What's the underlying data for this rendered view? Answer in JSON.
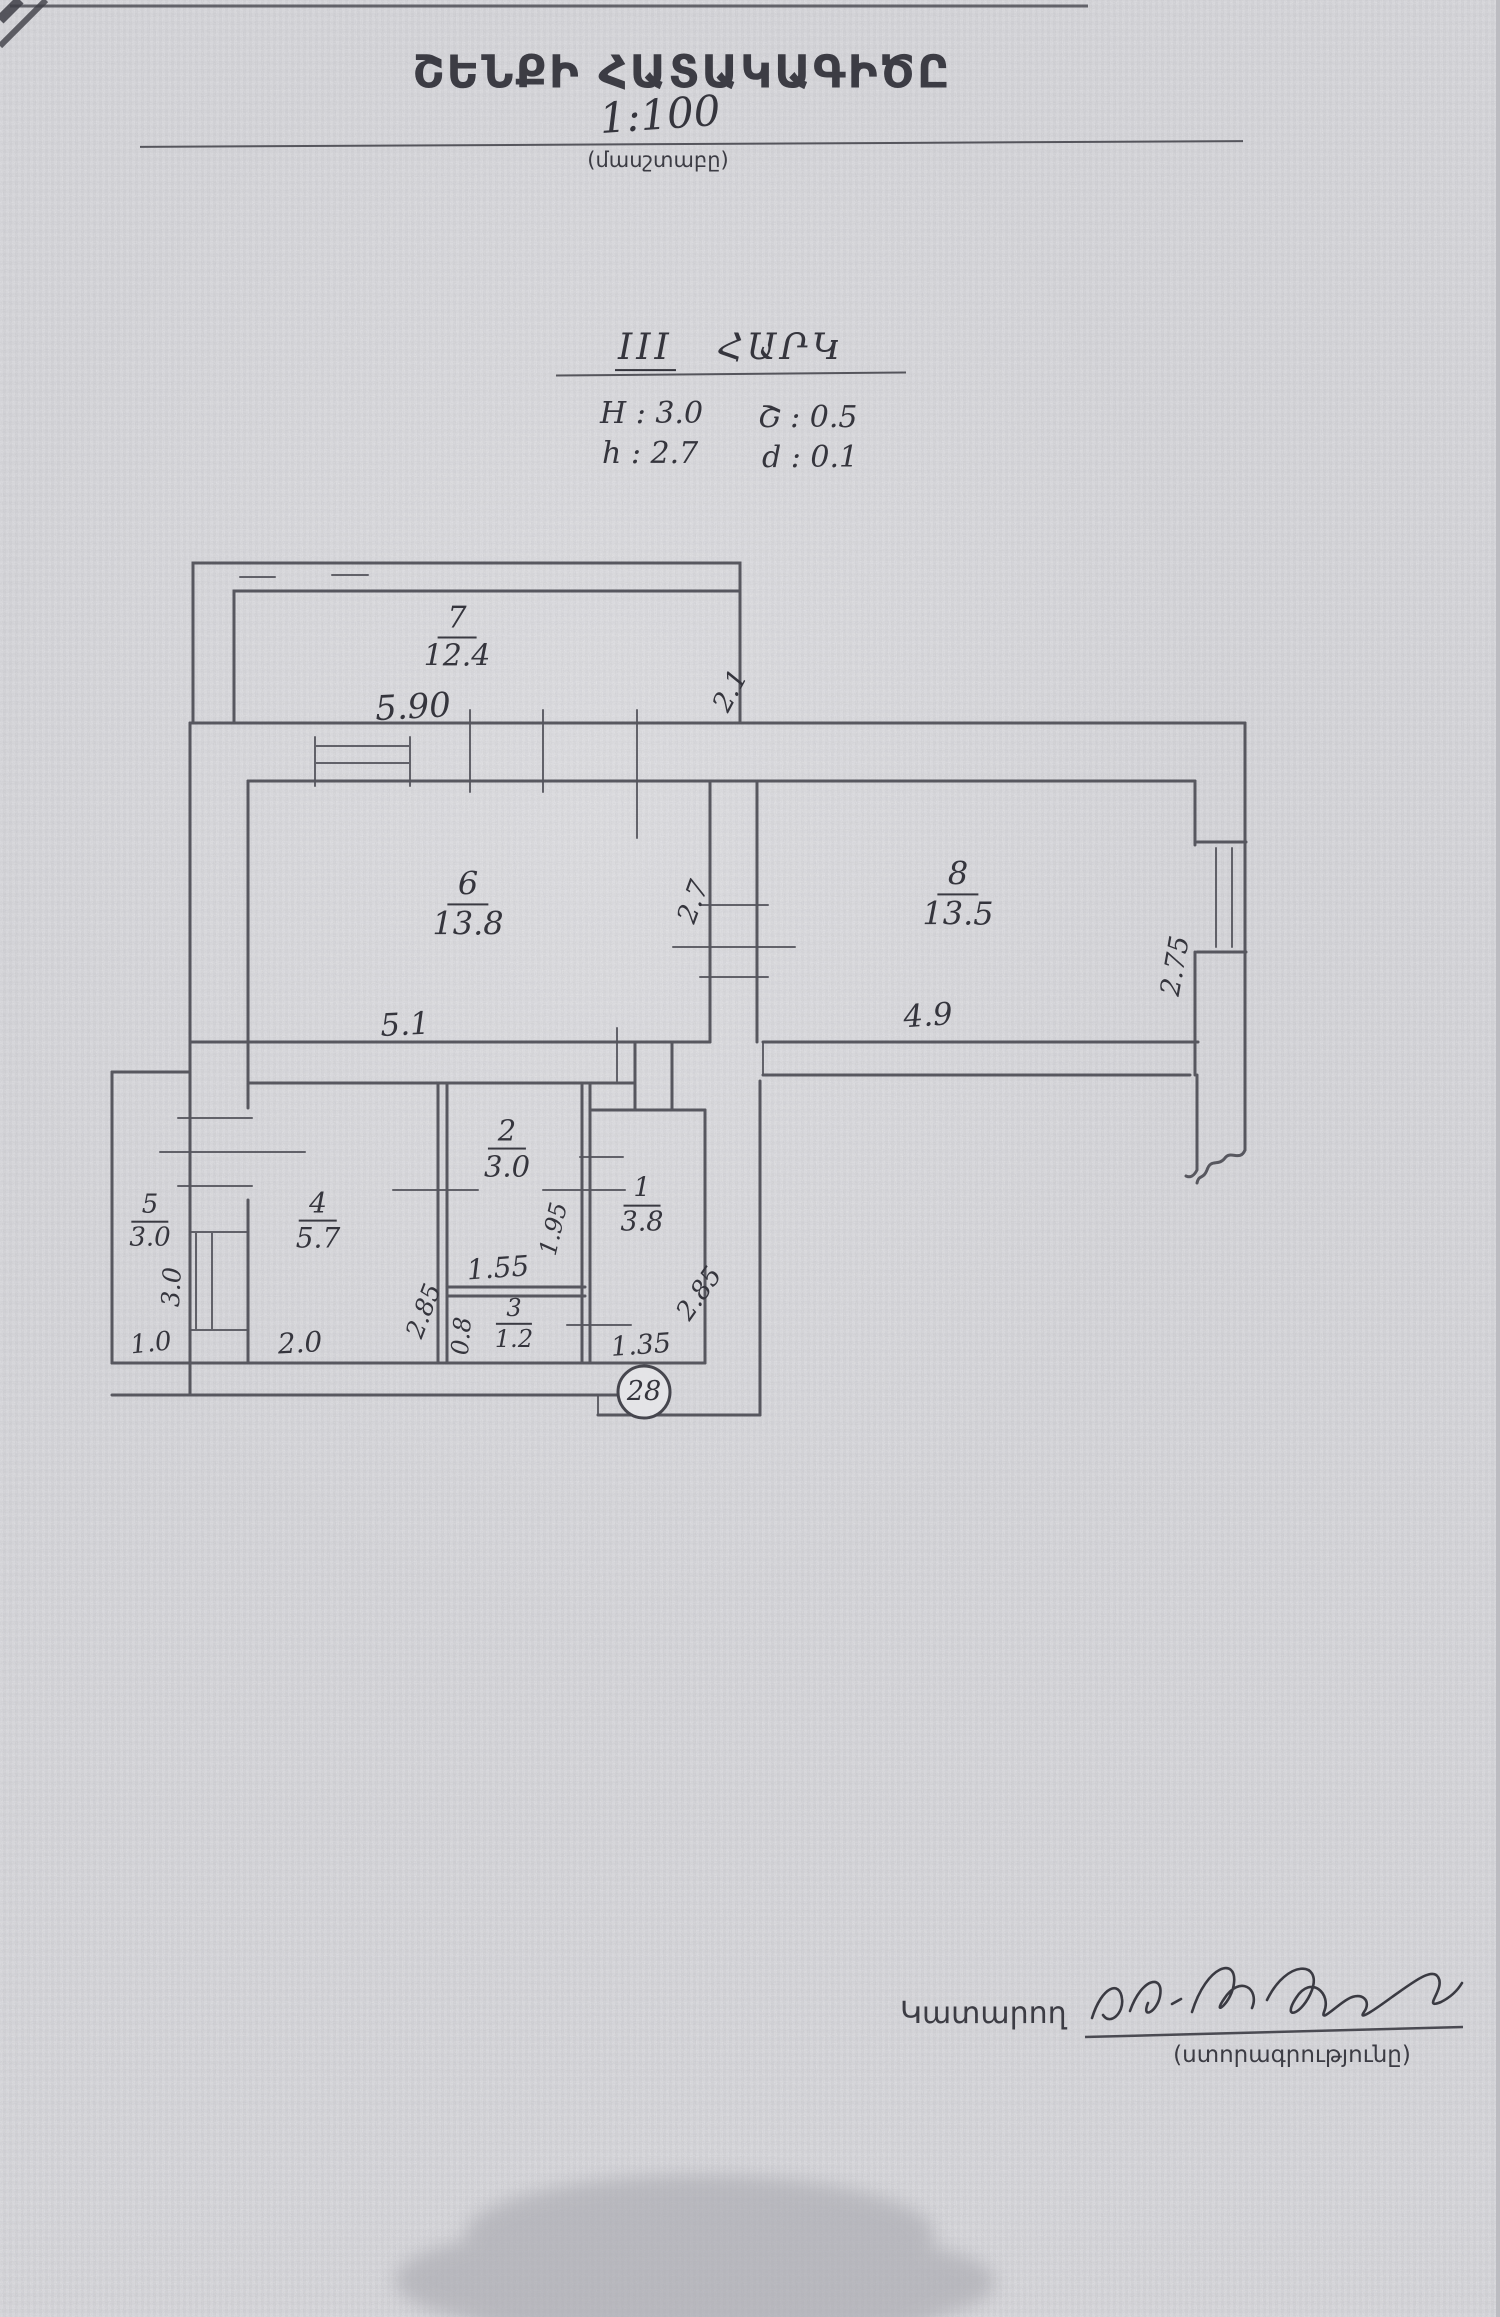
{
  "title": {
    "heading": "ՇԵՆՔԻ ՀԱՏԱԿԱԳԻԾԸ",
    "scale": "1:100",
    "scale_caption": "(մասշտաբը)"
  },
  "floor_header": {
    "roman": "III",
    "word": "ՀԱՐԿ",
    "param_H": "H : 3.0",
    "param_sh": "Շ : 0.5",
    "param_h": "h : 2.7",
    "param_d": "d : 0.1"
  },
  "plan": {
    "rooms": {
      "r1": {
        "n": "1",
        "a": "3.8"
      },
      "r2": {
        "n": "2",
        "a": "3.0"
      },
      "r3": {
        "n": "3",
        "a": "1.2"
      },
      "r4": {
        "n": "4",
        "a": "5.7"
      },
      "r5": {
        "n": "5",
        "a": "3.0"
      },
      "r6": {
        "n": "6",
        "a": "13.8"
      },
      "r7": {
        "n": "7",
        "a": "12.4"
      },
      "r8": {
        "n": "8",
        "a": "13.5"
      }
    },
    "dims": {
      "w590": "5.90",
      "w21": "2.1",
      "w27": "2.7",
      "w275": "2.75",
      "w51": "5.1",
      "w49": "4.9",
      "w30": "3.0",
      "w10": "1.0",
      "w20": "2.0",
      "w285a": "2.85",
      "w155": "1.55",
      "w195": "1.95",
      "w08": "0.8",
      "w135": "1.35",
      "w285b": "2.85"
    },
    "apartment_number": "28"
  },
  "footer": {
    "executor": "Կատարող",
    "signature_caption": "(ստորագրությունը)"
  },
  "colors": {
    "paper": "#e3e3e6",
    "ink_walls": "#4d4d55",
    "ink_text": "#35353d"
  }
}
